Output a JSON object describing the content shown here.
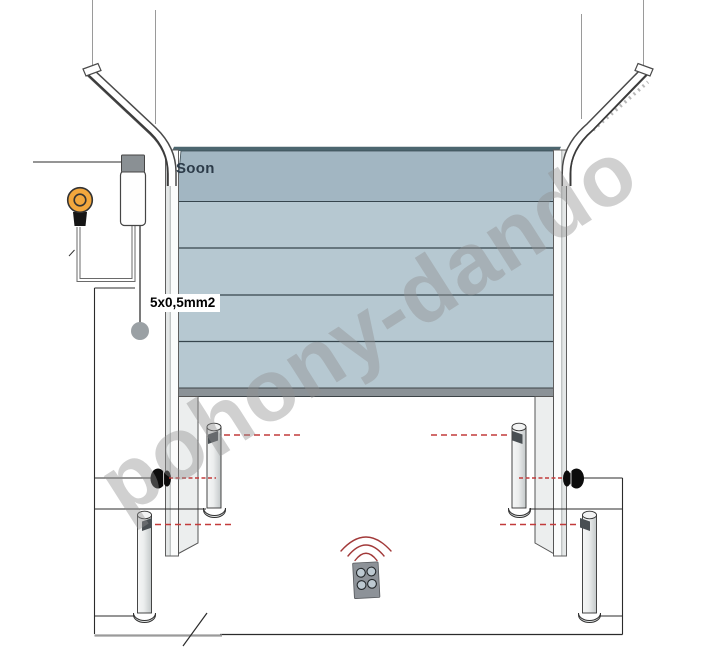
{
  "diagram": {
    "drive_brand_label": "Soon",
    "cable_label": "5x0,5mm2",
    "watermark_text": "pohony-dando"
  },
  "colors": {
    "panel_light": "#b6c8d1",
    "panel_dark": "#a2b6c2",
    "door_top_edge": "#4c666f",
    "bottom_rail": "#8b9297",
    "motor_cap": "#8a9094",
    "lamp": "#f2a73d",
    "beam_red": "#c23b3b",
    "wave_red": "#a23939",
    "remote_body": "#8d9298",
    "remote_button": "#bdc9d1",
    "button_gray": "#9aa0a4",
    "watermark": "#919191"
  }
}
